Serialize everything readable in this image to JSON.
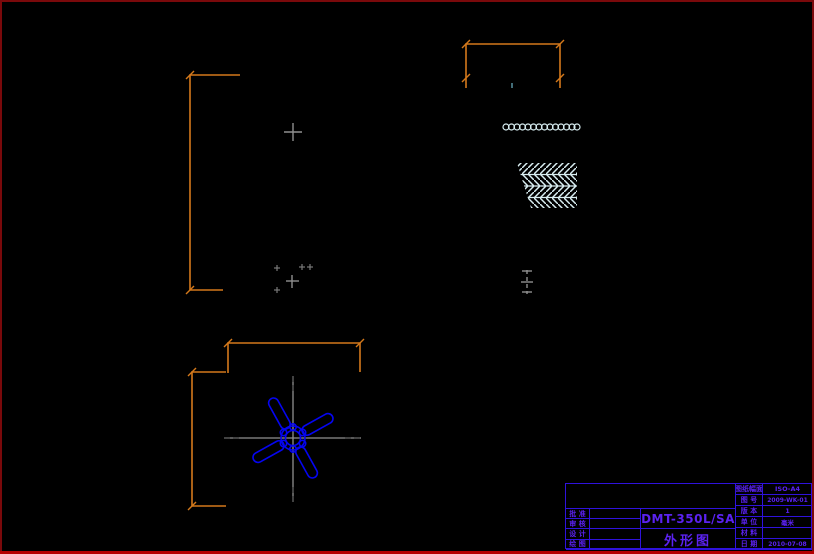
{
  "drawing": {
    "product_model": "DMT-350L/SA",
    "drawing_title": "外形图"
  },
  "title_block": {
    "left_rows": [
      {
        "label": "批 准",
        "value": ""
      },
      {
        "label": "审 核",
        "value": ""
      },
      {
        "label": "设 计",
        "value": ""
      },
      {
        "label": "绘 图",
        "value": ""
      }
    ],
    "right_rows": [
      {
        "label": "图纸幅面",
        "value": "ISO-A4"
      },
      {
        "label": "图 号",
        "value": "2009-WK-01"
      },
      {
        "label": "版 本",
        "value": "1"
      },
      {
        "label": "单 位",
        "value": "毫米"
      },
      {
        "label": "材 料",
        "value": ""
      },
      {
        "label": "日 期",
        "value": "2010-07-08"
      }
    ]
  },
  "colors": {
    "background": "#000000",
    "page_border": "#7a090b",
    "page_border_bottom": "#b40000",
    "dimension_lines": "#d4791b",
    "centerlines": "#8f8f8f",
    "fan_outline": "#0505f0",
    "hatch": "#d9eef2",
    "title_block_lines": "#2f12dc",
    "title_block_text": "#5b22f0"
  }
}
